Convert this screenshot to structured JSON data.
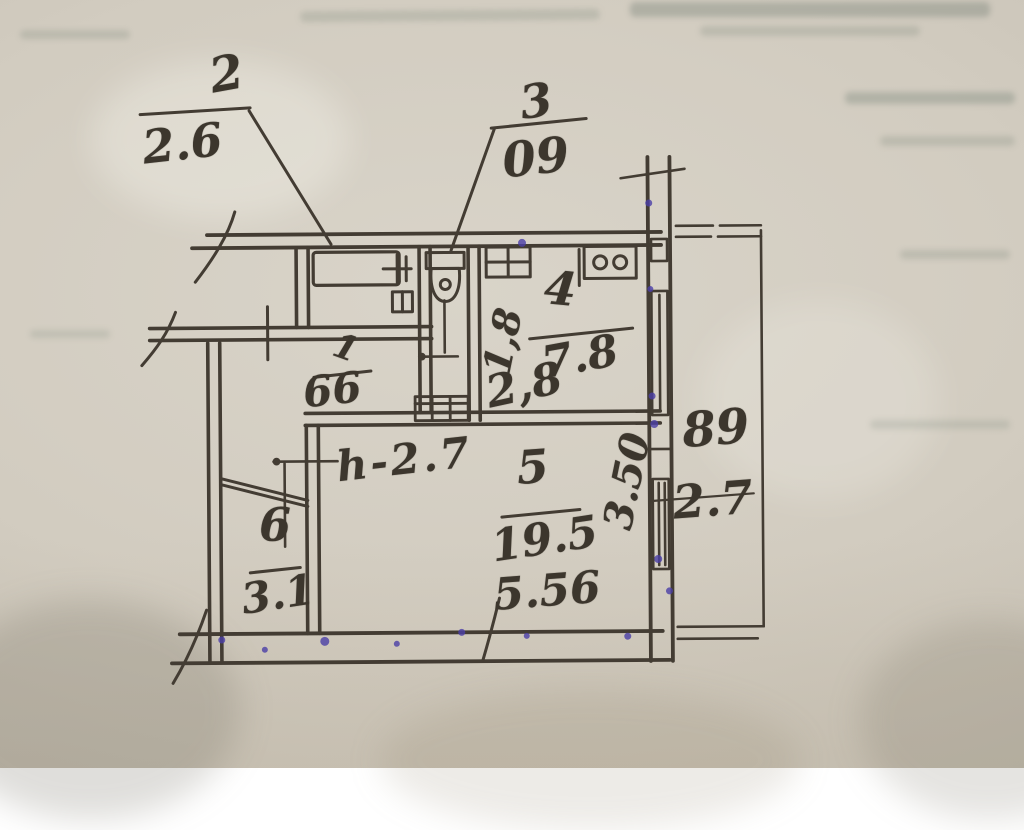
{
  "plan": {
    "title_hint": "hand-drawn apartment floor plan",
    "ink_color": "#433c33",
    "paper_color": "#d2ccc0",
    "ink_dot_color": "#4b3fa7",
    "rooms": [
      {
        "number": "1",
        "area": "66"
      },
      {
        "number": "2",
        "area": "2.6"
      },
      {
        "number": "3",
        "area": "09"
      },
      {
        "number": "4",
        "area": "7.8"
      },
      {
        "number": "5",
        "area": "19.5"
      },
      {
        "number": "6",
        "area": "3.1"
      }
    ],
    "dims": {
      "kitchen_width": "2,8",
      "kitchen_depth": "1,8",
      "room5_width": "5.56",
      "room5_depth": "3.50",
      "ceiling_height": "h-2.7"
    },
    "balcony": {
      "label_top": "89",
      "label_bottom": "2.7"
    }
  }
}
